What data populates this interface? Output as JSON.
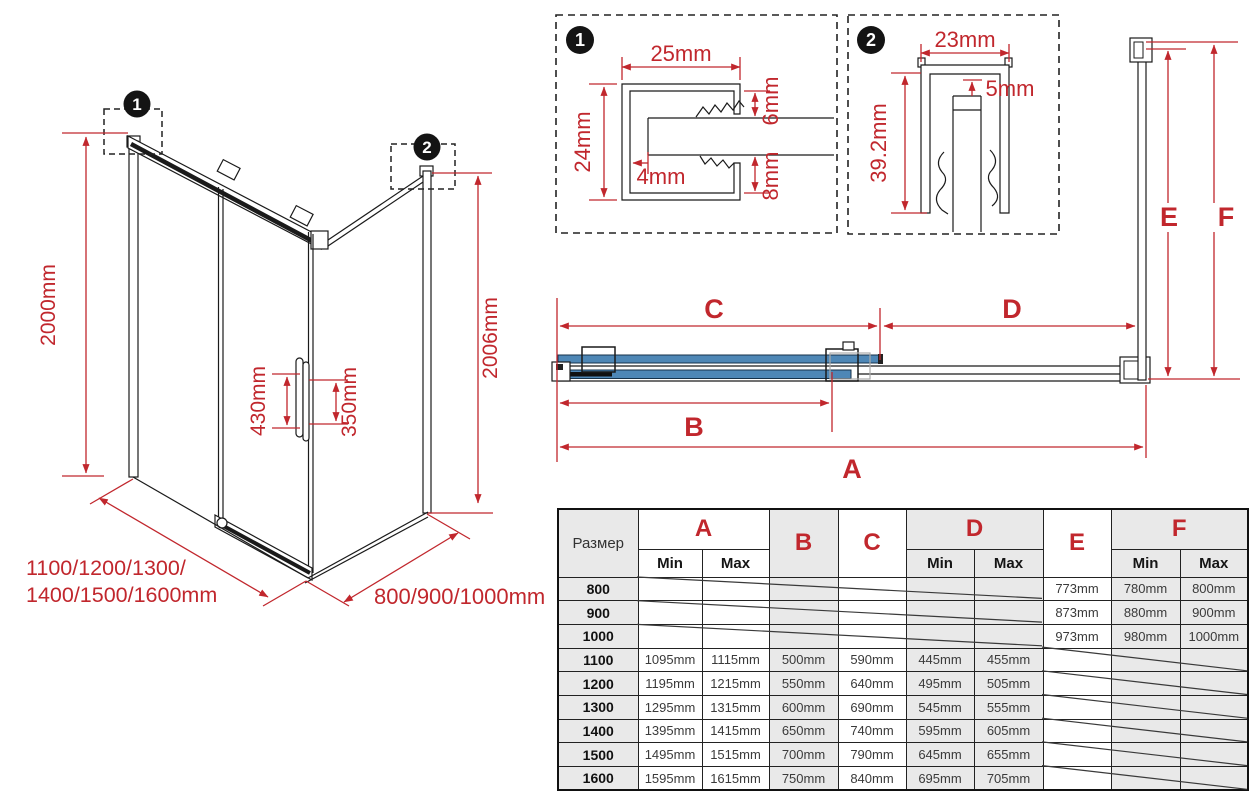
{
  "colors": {
    "red": "#c1272d",
    "glass_blue": "#4e87b6",
    "table_gray": "#e9e9e9"
  },
  "iso": {
    "marker1": "1",
    "marker2": "2",
    "height_left": "2000mm",
    "height_right": "2006mm",
    "handle_height": "430mm",
    "handle_inner": "350mm",
    "width_line1": "1100/1200/1300/",
    "width_line2": "1400/1500/1600mm",
    "depth_label": "800/900/1000mm"
  },
  "detail1": {
    "marker": "1",
    "width": "25mm",
    "height": "24mm",
    "glass_inset": "4mm",
    "top_gap": "6mm",
    "bottom_gap": "8mm"
  },
  "detail2": {
    "marker": "2",
    "width": "23mm",
    "top_gap": "5mm",
    "height": "39.2mm"
  },
  "plan": {
    "labels": {
      "a": "A",
      "b": "B",
      "c": "C",
      "d": "D",
      "e": "E",
      "f": "F"
    }
  },
  "table": {
    "size_header": "Размер",
    "min_label": "Min",
    "max_label": "Max",
    "groups": [
      "A",
      "B",
      "C",
      "D",
      "E",
      "F"
    ],
    "rows": [
      {
        "size": "800",
        "a_min": "",
        "a_max": "",
        "b": "",
        "c": "",
        "d_min": "",
        "d_max": "",
        "e": "773mm",
        "f_min": "780mm",
        "f_max": "800mm"
      },
      {
        "size": "900",
        "a_min": "",
        "a_max": "",
        "b": "",
        "c": "",
        "d_min": "",
        "d_max": "",
        "e": "873mm",
        "f_min": "880mm",
        "f_max": "900mm"
      },
      {
        "size": "1000",
        "a_min": "",
        "a_max": "",
        "b": "",
        "c": "",
        "d_min": "",
        "d_max": "",
        "e": "973mm",
        "f_min": "980mm",
        "f_max": "1000mm"
      },
      {
        "size": "1100",
        "a_min": "1095mm",
        "a_max": "1115mm",
        "b": "500mm",
        "c": "590mm",
        "d_min": "445mm",
        "d_max": "455mm",
        "e": "",
        "f_min": "",
        "f_max": ""
      },
      {
        "size": "1200",
        "a_min": "1195mm",
        "a_max": "1215mm",
        "b": "550mm",
        "c": "640mm",
        "d_min": "495mm",
        "d_max": "505mm",
        "e": "",
        "f_min": "",
        "f_max": ""
      },
      {
        "size": "1300",
        "a_min": "1295mm",
        "a_max": "1315mm",
        "b": "600mm",
        "c": "690mm",
        "d_min": "545mm",
        "d_max": "555mm",
        "e": "",
        "f_min": "",
        "f_max": ""
      },
      {
        "size": "1400",
        "a_min": "1395mm",
        "a_max": "1415mm",
        "b": "650mm",
        "c": "740mm",
        "d_min": "595mm",
        "d_max": "605mm",
        "e": "",
        "f_min": "",
        "f_max": ""
      },
      {
        "size": "1500",
        "a_min": "1495mm",
        "a_max": "1515mm",
        "b": "700mm",
        "c": "790mm",
        "d_min": "645mm",
        "d_max": "655mm",
        "e": "",
        "f_min": "",
        "f_max": ""
      },
      {
        "size": "1600",
        "a_min": "1595mm",
        "a_max": "1615mm",
        "b": "750mm",
        "c": "840mm",
        "d_min": "695mm",
        "d_max": "705mm",
        "e": "",
        "f_min": "",
        "f_max": ""
      }
    ]
  }
}
